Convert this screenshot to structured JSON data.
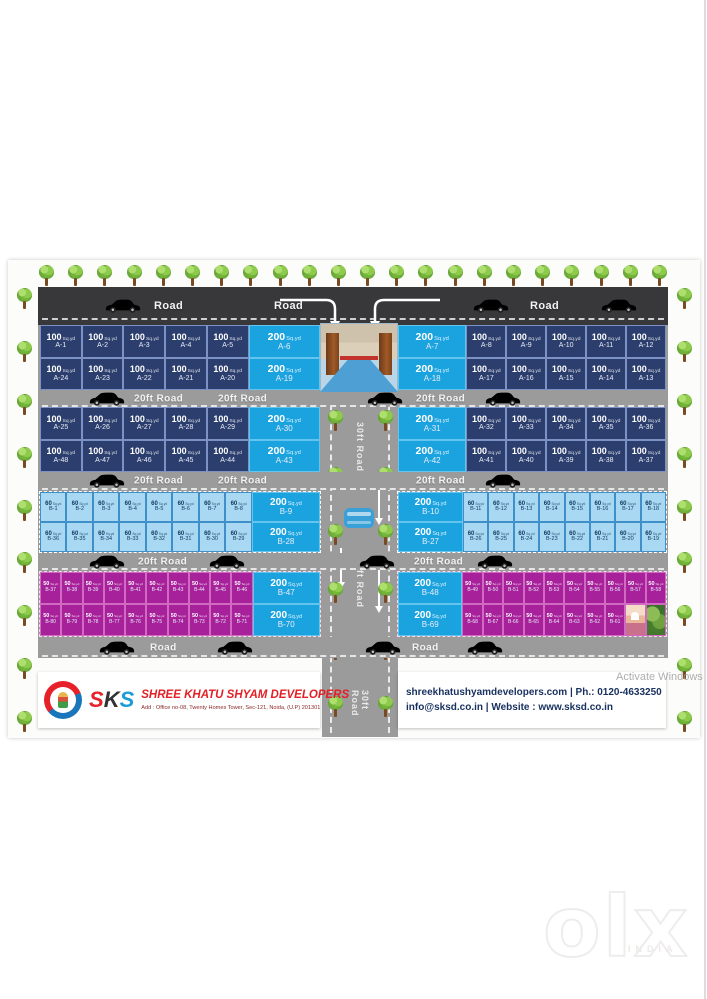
{
  "colors": {
    "navy": "#2c3e6d",
    "cyan": "#1ba3e0",
    "lightblue": "#a9d9f2",
    "purple": "#a7219b",
    "road_dark": "#38383a",
    "road": "#9b9b9b",
    "tree": "#7cbf3f",
    "company_red": "#e31e24",
    "contact_navy": "#17305f",
    "logo_red": "#e62129",
    "logo_blue": "#1b75bb",
    "car_blue": "#3aa0d8",
    "cars": {
      "silver": "#ededed",
      "red": "#e12726",
      "green": "#23a638"
    },
    "logo_letter_colors": [
      "#e62129",
      "#333333",
      "#1b9cd8"
    ]
  },
  "poster": {
    "unit": "Sq.yd",
    "vertical_road": {
      "label": "30ft Road"
    },
    "roads": [
      {
        "id": "top",
        "items": [
          {
            "x": 66,
            "car": "silver"
          },
          {
            "x": 116,
            "label": "Road"
          },
          {
            "x": 236,
            "label": "Road"
          },
          {
            "x": 434,
            "car": "red"
          },
          {
            "x": 492,
            "label": "Road"
          },
          {
            "x": 562,
            "car": "green"
          }
        ]
      },
      {
        "id": "r1",
        "items": [
          {
            "x": 50,
            "car": "silver"
          },
          {
            "x": 96,
            "label": "20ft Road"
          },
          {
            "x": 180,
            "label": "20ft Road"
          },
          {
            "x": 328,
            "car": "red"
          },
          {
            "x": 378,
            "label": "20ft Road"
          },
          {
            "x": 446,
            "car": "silver"
          }
        ]
      },
      {
        "id": "r2",
        "items": [
          {
            "x": 50,
            "car": "silver"
          },
          {
            "x": 96,
            "label": "20ft Road"
          },
          {
            "x": 180,
            "label": "20ft Road"
          },
          {
            "x": 378,
            "label": "20ft Road"
          },
          {
            "x": 446,
            "car": "green"
          }
        ]
      },
      {
        "id": "r3",
        "items": [
          {
            "x": 50,
            "car": "silver"
          },
          {
            "x": 100,
            "label": "20ft Road"
          },
          {
            "x": 170,
            "car": "red"
          },
          {
            "x": 320,
            "car": "red"
          },
          {
            "x": 376,
            "label": "20ft Road"
          },
          {
            "x": 438,
            "car": "green"
          }
        ]
      },
      {
        "id": "rb",
        "items": [
          {
            "x": 60,
            "car": "silver"
          },
          {
            "x": 112,
            "label": "Road"
          },
          {
            "x": 178,
            "car": "green"
          },
          {
            "x": 326,
            "car": "red"
          },
          {
            "x": 374,
            "label": "Road"
          },
          {
            "x": 428,
            "car": "green"
          }
        ]
      }
    ],
    "tree_counts": {
      "top": 22,
      "side": 9,
      "center": 6
    },
    "blocks": {
      "s1l": {
        "small": "navy",
        "rows": [
          [
            [
              "100",
              "A-1"
            ],
            [
              "100",
              "A-2"
            ],
            [
              "100",
              "A-3"
            ],
            [
              "100",
              "A-4"
            ],
            [
              "100",
              "A-5"
            ],
            [
              "200",
              "A-6"
            ]
          ],
          [
            [
              "100",
              "A-24"
            ],
            [
              "100",
              "A-23"
            ],
            [
              "100",
              "A-22"
            ],
            [
              "100",
              "A-21"
            ],
            [
              "100",
              "A-20"
            ],
            [
              "200",
              "A-19"
            ]
          ]
        ]
      },
      "s1r": {
        "small": "navy",
        "rows": [
          [
            [
              "200",
              "A-7"
            ],
            [
              "100",
              "A-8"
            ],
            [
              "100",
              "A-9"
            ],
            [
              "100",
              "A-10"
            ],
            [
              "100",
              "A-11"
            ],
            [
              "100",
              "A-12"
            ]
          ],
          [
            [
              "200",
              "A-18"
            ],
            [
              "100",
              "A-17"
            ],
            [
              "100",
              "A-16"
            ],
            [
              "100",
              "A-15"
            ],
            [
              "100",
              "A-14"
            ],
            [
              "100",
              "A-13"
            ]
          ]
        ]
      },
      "s2l": {
        "small": "navy",
        "rows": [
          [
            [
              "100",
              "A-25"
            ],
            [
              "100",
              "A-26"
            ],
            [
              "100",
              "A-27"
            ],
            [
              "100",
              "A-28"
            ],
            [
              "100",
              "A-29"
            ],
            [
              "200",
              "A-30"
            ]
          ],
          [
            [
              "100",
              "A-48"
            ],
            [
              "100",
              "A-47"
            ],
            [
              "100",
              "A-46"
            ],
            [
              "100",
              "A-45"
            ],
            [
              "100",
              "A-44"
            ],
            [
              "200",
              "A-43"
            ]
          ]
        ]
      },
      "s2r": {
        "small": "navy",
        "rows": [
          [
            [
              "200",
              "A-31"
            ],
            [
              "100",
              "A-32"
            ],
            [
              "100",
              "A-33"
            ],
            [
              "100",
              "A-34"
            ],
            [
              "100",
              "A-35"
            ],
            [
              "100",
              "A-36"
            ]
          ],
          [
            [
              "200",
              "A-42"
            ],
            [
              "100",
              "A-41"
            ],
            [
              "100",
              "A-40"
            ],
            [
              "100",
              "A-39"
            ],
            [
              "100",
              "A-38"
            ],
            [
              "100",
              "A-37"
            ]
          ]
        ]
      },
      "s3l": {
        "small": "lightblue",
        "rows": [
          [
            [
              "60",
              "B-1"
            ],
            [
              "60",
              "B-2"
            ],
            [
              "60",
              "B-3"
            ],
            [
              "60",
              "B-4"
            ],
            [
              "60",
              "B-5"
            ],
            [
              "60",
              "B-6"
            ],
            [
              "60",
              "B-7"
            ],
            [
              "60",
              "B-8"
            ],
            [
              "200",
              "B-9"
            ]
          ],
          [
            [
              "60",
              "B-36"
            ],
            [
              "60",
              "B-35"
            ],
            [
              "60",
              "B-34"
            ],
            [
              "60",
              "B-33"
            ],
            [
              "60",
              "B-32"
            ],
            [
              "60",
              "B-31"
            ],
            [
              "60",
              "B-30"
            ],
            [
              "60",
              "B-29"
            ],
            [
              "200",
              "B-28"
            ]
          ]
        ]
      },
      "s3r": {
        "small": "lightblue",
        "rows": [
          [
            [
              "200",
              "B-10"
            ],
            [
              "60",
              "B-11"
            ],
            [
              "60",
              "B-12"
            ],
            [
              "60",
              "B-13"
            ],
            [
              "60",
              "B-14"
            ],
            [
              "60",
              "B-15"
            ],
            [
              "60",
              "B-16"
            ],
            [
              "60",
              "B-17"
            ],
            [
              "60",
              "B-18"
            ]
          ],
          [
            [
              "200",
              "B-27"
            ],
            [
              "60",
              "B-26"
            ],
            [
              "60",
              "B-25"
            ],
            [
              "60",
              "B-24"
            ],
            [
              "60",
              "B-23"
            ],
            [
              "60",
              "B-22"
            ],
            [
              "60",
              "B-21"
            ],
            [
              "60",
              "B-20"
            ],
            [
              "60",
              "B-19"
            ]
          ]
        ]
      },
      "s4l": {
        "small": "purple",
        "rows": [
          [
            [
              "50",
              "B-37"
            ],
            [
              "50",
              "B-38"
            ],
            [
              "50",
              "B-39"
            ],
            [
              "50",
              "B-40"
            ],
            [
              "50",
              "B-41"
            ],
            [
              "50",
              "B-42"
            ],
            [
              "50",
              "B-43"
            ],
            [
              "50",
              "B-44"
            ],
            [
              "50",
              "B-45"
            ],
            [
              "50",
              "B-46"
            ],
            [
              "200",
              "B-47"
            ]
          ],
          [
            [
              "50",
              "B-80"
            ],
            [
              "50",
              "B-79"
            ],
            [
              "50",
              "B-78"
            ],
            [
              "50",
              "B-77"
            ],
            [
              "50",
              "B-76"
            ],
            [
              "50",
              "B-75"
            ],
            [
              "50",
              "B-74"
            ],
            [
              "50",
              "B-73"
            ],
            [
              "50",
              "B-72"
            ],
            [
              "50",
              "B-71"
            ],
            [
              "200",
              "B-70"
            ]
          ]
        ]
      },
      "s4r": {
        "small": "purple",
        "rows": [
          [
            [
              "200",
              "B-48"
            ],
            [
              "50",
              "B-49"
            ],
            [
              "50",
              "B-50"
            ],
            [
              "50",
              "B-51"
            ],
            [
              "50",
              "B-52"
            ],
            [
              "50",
              "B-53"
            ],
            [
              "50",
              "B-54"
            ],
            [
              "50",
              "B-55"
            ],
            [
              "50",
              "B-56"
            ],
            [
              "50",
              "B-57"
            ],
            [
              "50",
              "B-58"
            ]
          ],
          [
            [
              "200",
              "B-69"
            ],
            [
              "50",
              "B-68"
            ],
            [
              "50",
              "B-67"
            ],
            [
              "50",
              "B-66"
            ],
            [
              "50",
              "B-65"
            ],
            [
              "50",
              "B-64"
            ],
            [
              "50",
              "B-63"
            ],
            [
              "50",
              "B-62"
            ],
            [
              "50",
              "B-61"
            ],
            [
              "img",
              "temple-photo"
            ],
            [
              "img",
              "tree-photo"
            ]
          ]
        ]
      }
    }
  },
  "footer": {
    "logo_text": "SKS",
    "company": "SHREE KHATU SHYAM DEVELOPERS",
    "address": "Add : Office no-08, Twenty Homes Tower, Sec-121, Noida, (U.P) 201301",
    "website_phone": "shreekhatushyamdevelopers.com  |  Ph.: 0120-4633250",
    "email_site": "info@sksd.co.in | Website  : www.sksd.co.in"
  },
  "watermarks": {
    "activate": "Activate Windows",
    "olx": "olx",
    "olx_country": "INDIA"
  },
  "icons": [
    "tree-icon",
    "car-side-icon",
    "car-top-icon",
    "lane-arrow-icon",
    "sks-logo",
    "entrance-gate-photo",
    "temple-photo",
    "tree-photo"
  ]
}
